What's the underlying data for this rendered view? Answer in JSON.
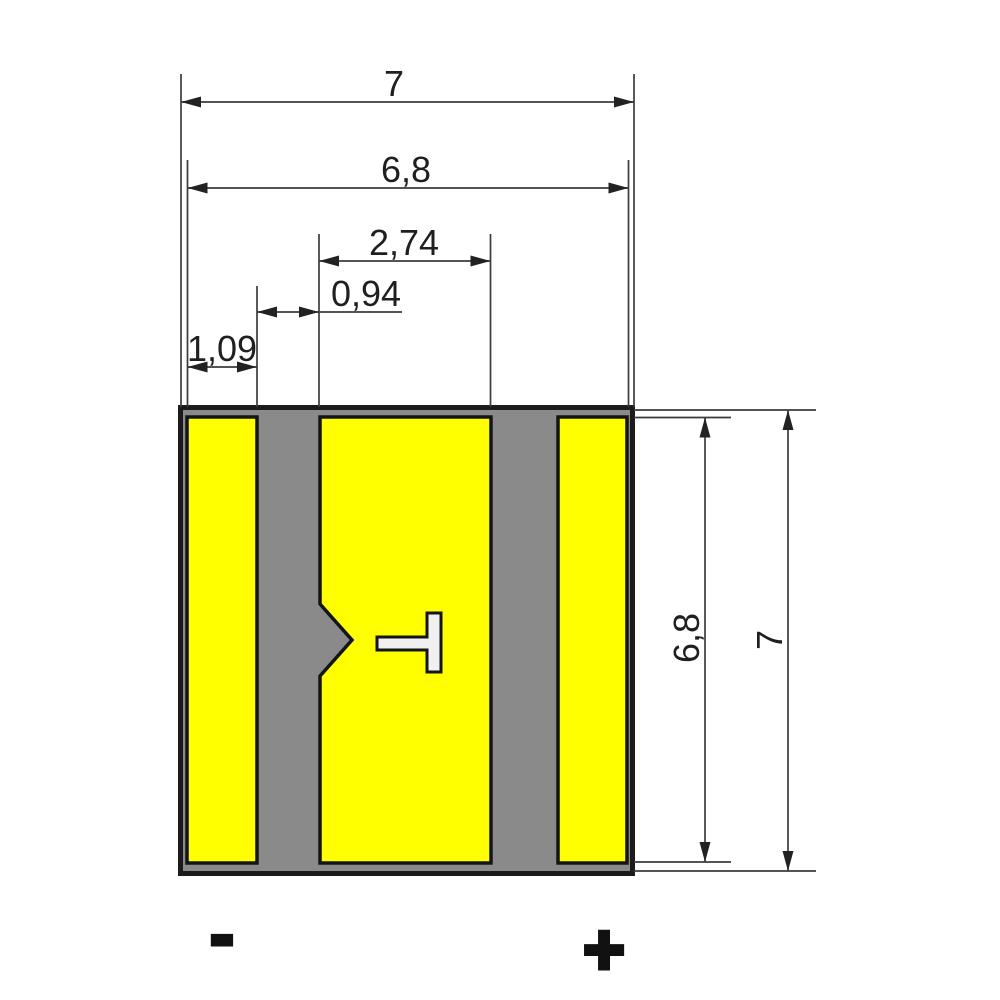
{
  "drawing": {
    "type": "component-land-pattern",
    "units_shown": false
  },
  "colors": {
    "background": "#ffffff",
    "body_fill": "#8a8a8a",
    "pad_fill": "#ffff00",
    "marker_fill": "#f0f0f0",
    "outline": "#1b1b1b",
    "dimension_line": "#3c3c3c",
    "text": "#1f1f1f"
  },
  "dimensions": {
    "outer_width": "7",
    "inner_width": "6,8",
    "center_pad_width": "2,74",
    "pad_gap_width": "0,94",
    "left_pad_width": "1,09",
    "inner_height": "6,8",
    "outer_height": "7"
  },
  "polarity": {
    "negative": "-",
    "positive": "+"
  }
}
